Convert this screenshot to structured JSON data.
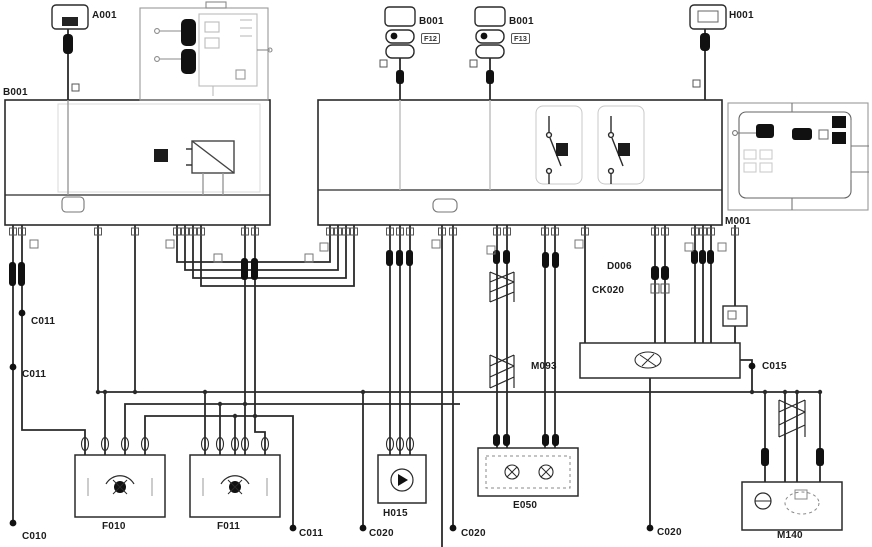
{
  "diagram": {
    "type": "automotive-wiring-schematic",
    "colors": {
      "background": "#ffffff",
      "line": "#2a2a2a",
      "faint": "#c9c9c9"
    },
    "labels": {
      "a001": "A001",
      "b001_box": "B001",
      "fuse1": "B001",
      "fuse1_sub": "F12",
      "fuse2": "B001",
      "fuse2_sub": "F13",
      "h001": "H001",
      "m001": "M001",
      "d006": "D006",
      "ck020": "CK020",
      "m093": "M093",
      "c015": "C015",
      "c011_upper": "C011",
      "c011_lower": "C011",
      "c010": "C010",
      "f010": "F010",
      "f011": "F011",
      "c011_bottom": "C011",
      "c020_left": "C020",
      "h015": "H015",
      "c020_mid": "C020",
      "e050": "E050",
      "c020_right": "C020",
      "m140": "M140"
    }
  }
}
